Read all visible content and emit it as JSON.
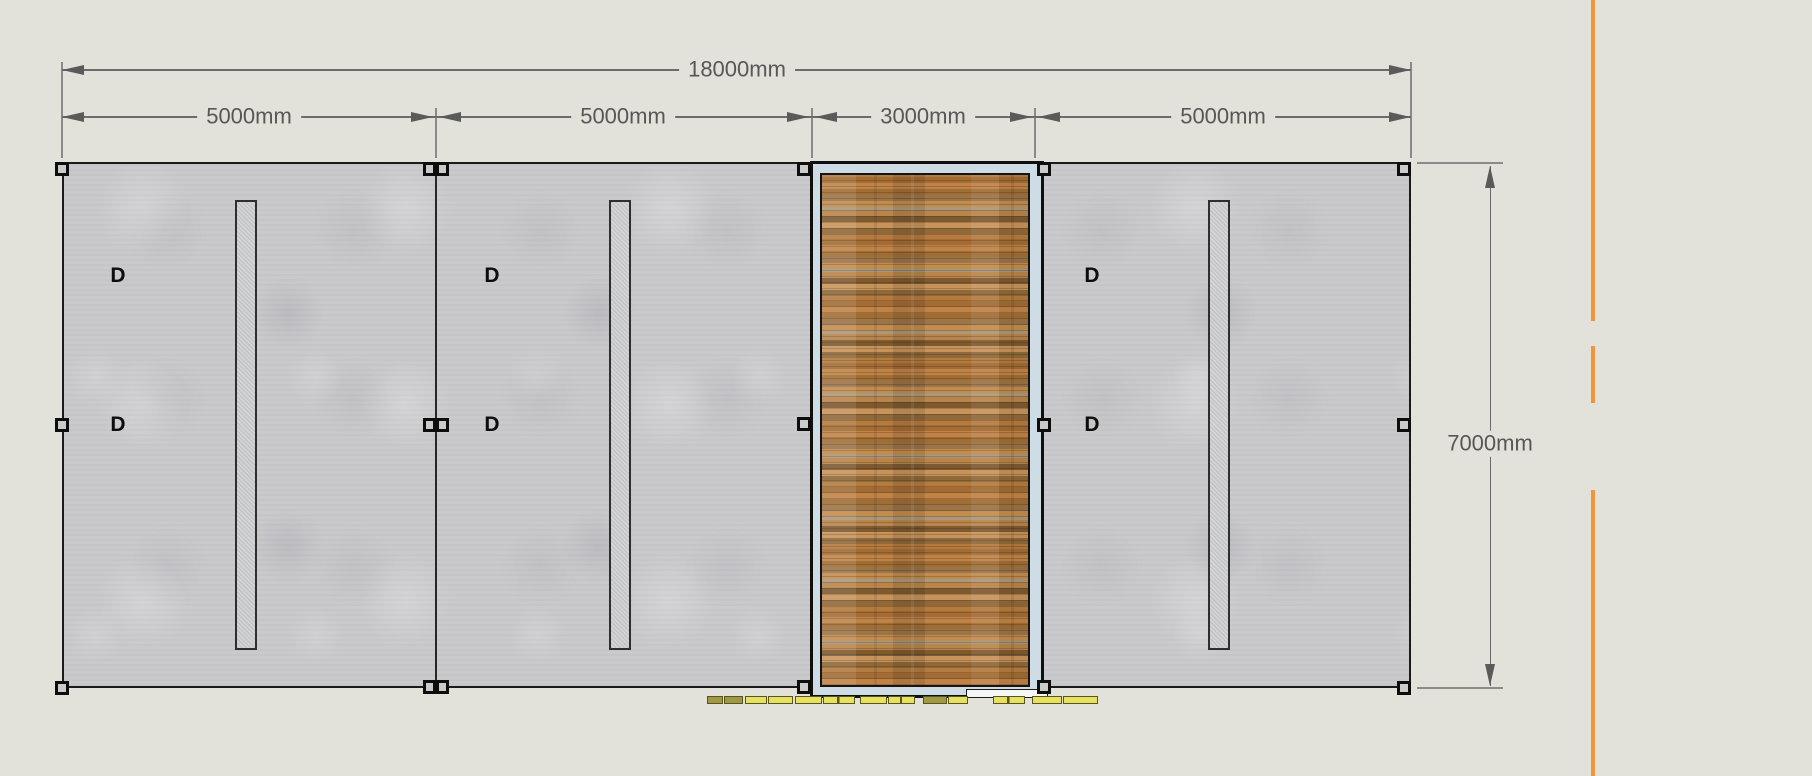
{
  "drawing": {
    "type": "wall-elevation",
    "dimensions": {
      "total": "18000mm",
      "bays": [
        "5000mm",
        "5000mm",
        "3000mm",
        "5000mm"
      ],
      "height": "7000mm"
    },
    "markers": {
      "door": "D"
    },
    "colors": {
      "background": "#e2e1da",
      "wall": "#cacacd",
      "frame_blue": "#cddce5",
      "wood_base": "#ad7a40",
      "guide_orange": "#f0953a",
      "footing_yellow": "#e6e160",
      "dimension_text": "#575757"
    }
  }
}
